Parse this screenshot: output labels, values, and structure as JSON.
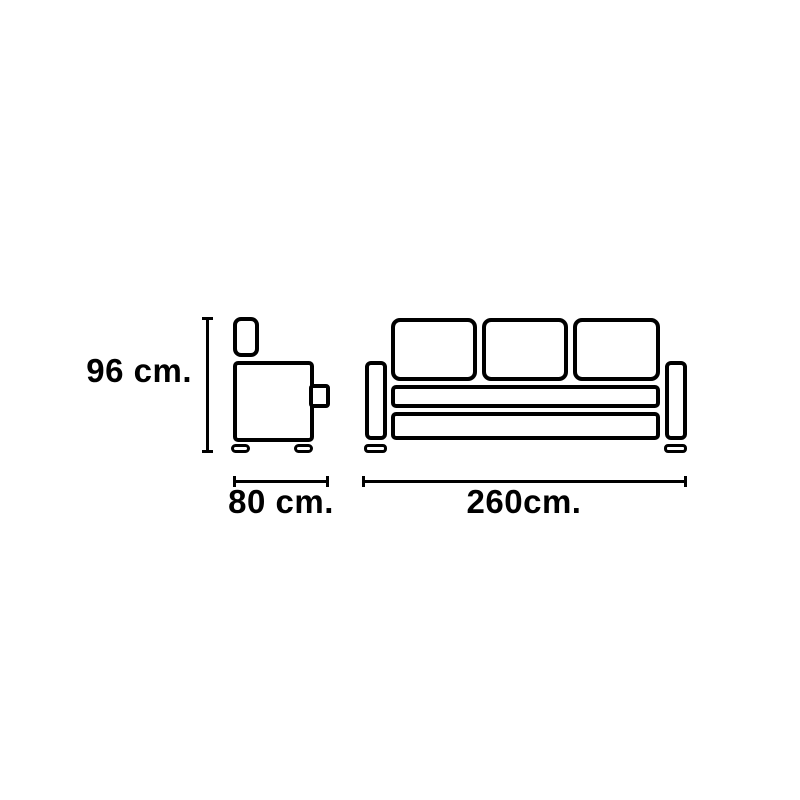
{
  "canvas": {
    "background": "#ffffff",
    "stroke_color": "#000000"
  },
  "diagram": {
    "kind": "sofa-dimension-line-drawing",
    "side_view": {
      "parts": [
        "headrest-cushion",
        "seat-body",
        "armrest-knob",
        "foot-left",
        "foot-right"
      ]
    },
    "front_view": {
      "back_cushion_count": 3,
      "parts": [
        "back-cushion-1",
        "back-cushion-2",
        "back-cushion-3",
        "armrest-left",
        "armrest-right",
        "seat-slat",
        "base-slat",
        "foot-left",
        "foot-right"
      ]
    },
    "dimensions": {
      "height": {
        "label": "96 cm.",
        "value": 96,
        "unit": "cm"
      },
      "depth": {
        "label": "80 cm.",
        "value": 80,
        "unit": "cm"
      },
      "width": {
        "label": "260cm.",
        "value": 260,
        "unit": "cm"
      }
    }
  }
}
